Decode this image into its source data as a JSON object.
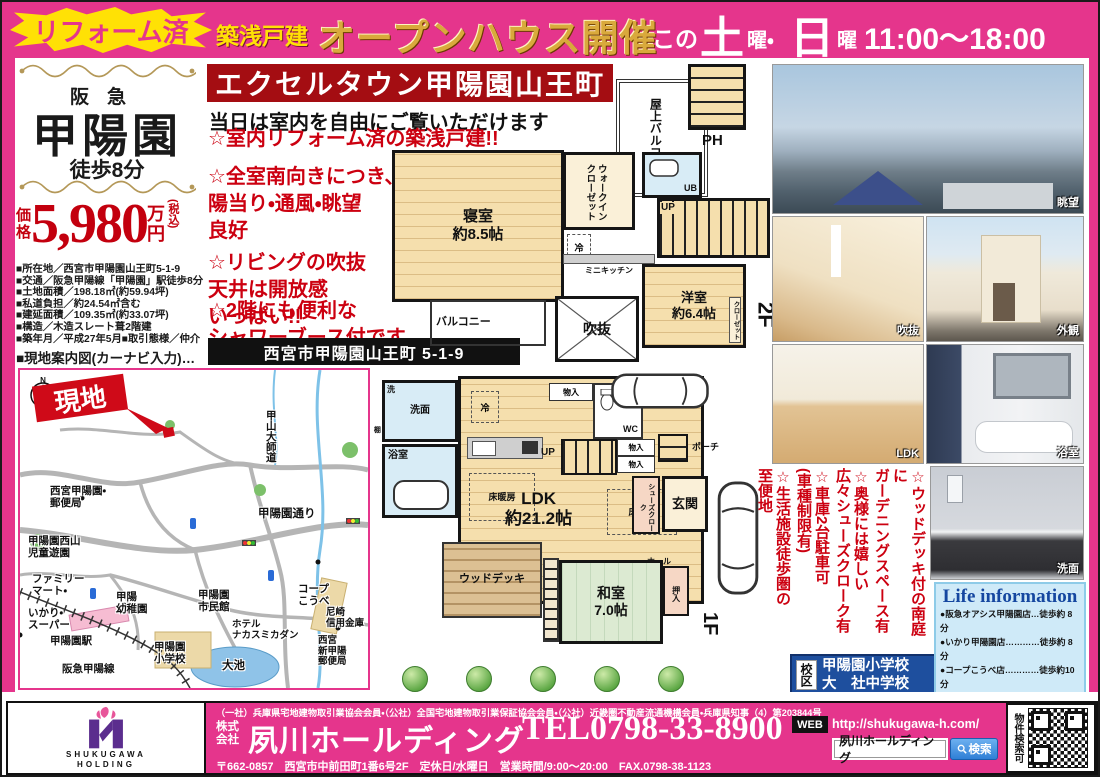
{
  "top_banner": {
    "burst": "リフォーム済",
    "sub": "築浅戸建",
    "title": "オープンハウス開催",
    "schedule_prefix": "この",
    "sat": "土",
    "sat_suffix": "曜・",
    "sun": "日",
    "sun_suffix": "曜",
    "time": "11:00〜18:00"
  },
  "left": {
    "line_name": "阪急",
    "station_name": "甲陽園",
    "walk": "徒歩8分",
    "price_label": "価\n格",
    "price_value": "5,980",
    "price_unit": "万\n円",
    "price_tax": "(税込)",
    "details": [
      "■所在地／西宮市甲陽園山王町5-1-9",
      "■交通／阪急甲陽線「甲陽園」駅徒歩8分",
      "■土地面積／198.18㎡(約59.94坪)",
      "■私道負担／約24.54㎡含む",
      "■建延面積／109.35㎡(約33.07坪)",
      "■構造／木造スレート葺2階建",
      "■築年月／平成27年5月■取引態様／仲介"
    ],
    "map_caption": "■現地案内図(カーナビ入力)…"
  },
  "center": {
    "title": "エクセルタウン甲陽園山王町",
    "subtitle": "当日は室内を自由にご覧いただけます",
    "bullets": [
      "☆室内リフォーム済の築浅戸建!!",
      "☆全室南向きにつき、\n陽当り・通風・眺望\n良好",
      "☆リビングの吹抜\n天井は開放感\nいっぱい!!",
      "☆2階にも便利な\nシャワーブース付です"
    ],
    "address_box": "西宮市甲陽園山王町 5-1-9"
  },
  "plan2f": {
    "rooftop_balcony": "屋上バルコニー",
    "ph": "PH",
    "bedroom": "寝室\n約8.5帖",
    "wic": "ウォークインクローゼット",
    "ub": "UB",
    "fridge": "冷",
    "mini_kitchen": "ミニキッチン",
    "up": "UP",
    "balcony": "バルコニー",
    "void": "吹抜",
    "western_room": "洋室\n約6.4帖",
    "closet": "クローゼット",
    "floor_label": "2F"
  },
  "plan1f": {
    "laundry": "洗",
    "washroom": "洗面",
    "bathroom": "浴室",
    "shelf": "棚",
    "fridge": "冷",
    "storage_top": "物入",
    "wc": "WC",
    "up": "UP",
    "storage_a": "物入",
    "storage_b": "物入",
    "porch": "ポーチ",
    "entrance": "玄関",
    "shoe_cloak": "シューズクローク",
    "hall": "ホール",
    "ldk": "LDK\n約21.2帖",
    "floor_heating_a": "床暖房",
    "floor_heating_b": "床暖房",
    "wood_deck": "ウッドデッキ",
    "japanese_room": "和室\n7.0帖",
    "oshiire": "押入",
    "floor_label": "1F"
  },
  "map": {
    "site": "現地",
    "koyama_daishido": "甲山大師道",
    "post_office_1": "西宮甲陽園・\n郵便局",
    "koyoen_dori": "甲陽園通り",
    "park": "甲陽園西山\n児童遊園",
    "familymart": "ファミリー\nマート・",
    "ikari": "いかり・\nスーパー",
    "station": "甲陽園駅",
    "hankyu_line": "阪急甲陽線",
    "kindergarten": "甲陽\n幼稚園",
    "civic_hall": "甲陽園\n市民館",
    "elementary": "甲陽園\n小学校",
    "pond": "大池",
    "hotel": "ホテル\nナカスミカダン",
    "coop": "コープ\nこうべ",
    "bank": "尼崎\n信用金庫",
    "post_office_2": "西宮\n新甲陽\n郵便局"
  },
  "photos": {
    "view": "眺望",
    "void": "吹抜",
    "exterior": "外観",
    "ldk": "LDK",
    "bathroom": "浴室",
    "washstand": "洗面"
  },
  "right": {
    "bullets": [
      "☆ウッドデッキ付の南庭に\nガーデニングスペース有",
      "☆奥様には嬉しい\n広々シューズクローク有",
      "☆車庫2台駐車可\n(車種制限有)",
      "☆生活施設徒歩圏の\n至便地"
    ],
    "school_label": "校区",
    "school_elementary": "甲陽園小学校",
    "school_junior": "大　社中学校",
    "life_title": "Life information",
    "life_items": [
      "●阪急オアシス甲陽園店…徒歩約 8 分",
      "●いかり甲陽園店…………徒歩約 8 分",
      "●コープこうべ店…………徒歩約10分",
      "●甲陽園郵便局 ……………徒歩約 5 分",
      "●尼崎信用金庫甲陽園…徒歩約10分",
      "●市立甲陽園小学校……徒歩約10分",
      "●市立大社中学校………徒歩約13分"
    ]
  },
  "footer": {
    "logo_line1": "SHUKUGAWA",
    "logo_line2": "HOLDING",
    "membership": "（一社）兵庫県宅地建物取引業協会会員・（公社）全国宅地建物取引業保証協会会員・（公社）近畿圏不動産流通機構会員・兵庫県知事（4）第203844号",
    "company_prefix": "株式\n会社",
    "company_name": "夙川ホールディング",
    "tel": "TEL0798-33-8900",
    "web_label": "WEB",
    "url": "http://shukugawa-h.com/",
    "search_box": "夙川ホールディング",
    "search_button": "検索",
    "qr_caption": "物件検索可",
    "info_line": "〒662-0857　西宮市中前田町1番6号2F　定休日/水曜日　営業時間/9:00〜20:00　FAX.0798-38-1123"
  }
}
